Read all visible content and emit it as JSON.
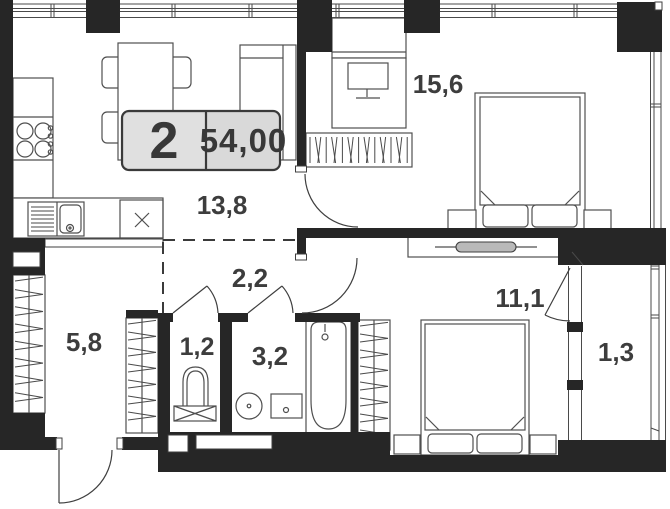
{
  "floor_plan": {
    "summary_badge": {
      "room_count": "2",
      "total_area": "54,00"
    },
    "rooms": [
      {
        "id": "living-kitchen",
        "area_label": "13,8"
      },
      {
        "id": "bedroom-main",
        "area_label": "15,6"
      },
      {
        "id": "bedroom-second",
        "area_label": "11,1"
      },
      {
        "id": "hallway",
        "area_label": "5,8"
      },
      {
        "id": "corridor",
        "area_label": "2,2"
      },
      {
        "id": "wc",
        "area_label": "1,2"
      },
      {
        "id": "bathroom",
        "area_label": "3,2"
      },
      {
        "id": "balcony",
        "area_label": "1,3"
      }
    ],
    "colors": {
      "wall": "#262626",
      "line": "#3f3f3f",
      "badge_fill": "#d9d9d9",
      "text": "#3d3d3d",
      "background": "#ffffff"
    }
  }
}
